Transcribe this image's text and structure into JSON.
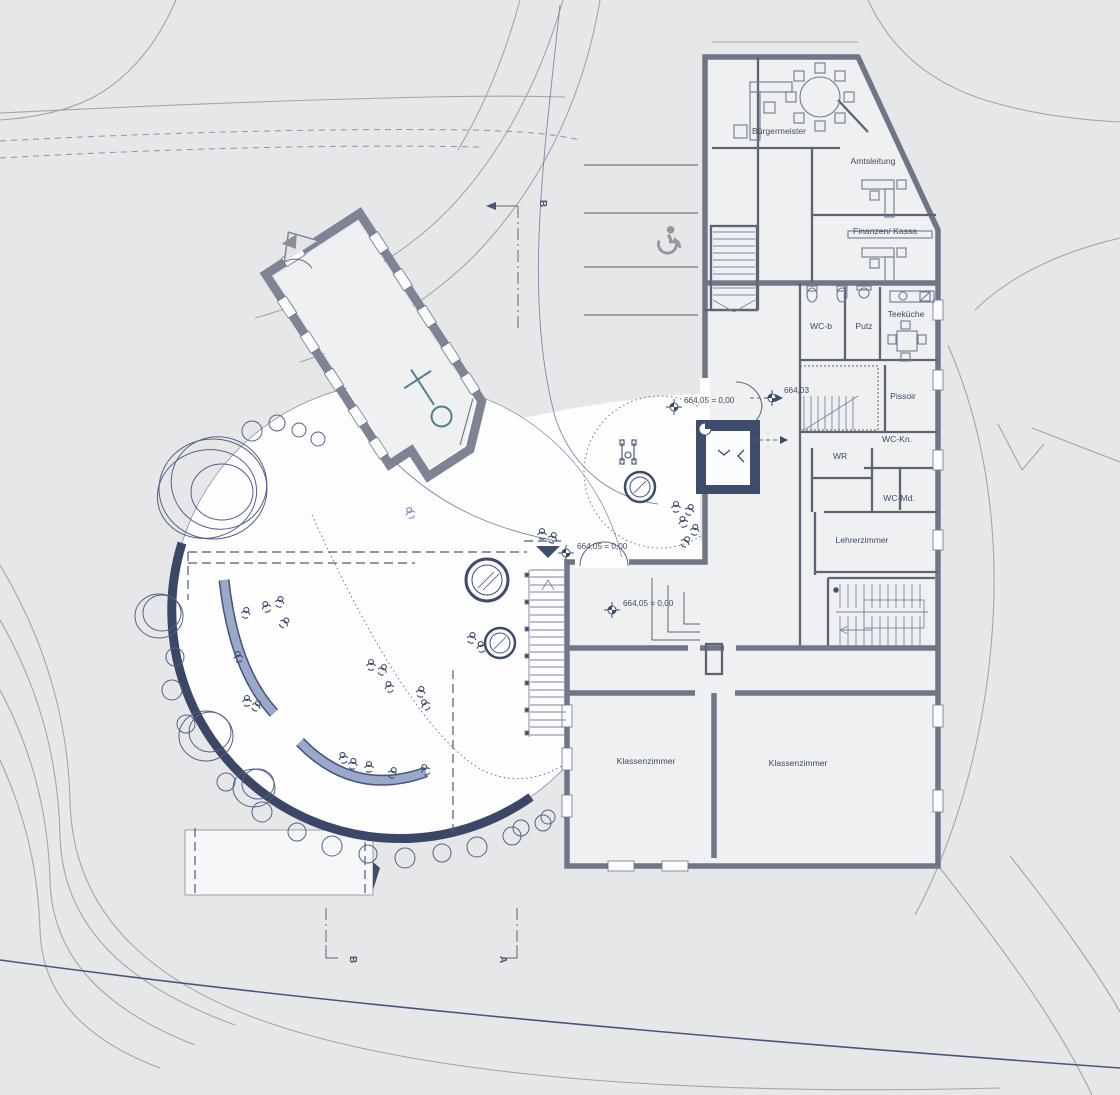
{
  "plan": {
    "type": "architectural-site-plan",
    "rooms": {
      "buergermeister": "Bürgermeister",
      "amtsleitung": "Amtsleitung",
      "finanzen": "Finanzen/ Kassa",
      "wc_b": "WC-b",
      "putz": "Putz",
      "teekueche": "Teeküche",
      "pissoir": "Pissoir",
      "wc_kn": "WC-Kn.",
      "wr": "WR",
      "wc_md": "WC-Md.",
      "lehrerzimmer": "Lehrerzimmer",
      "klassenzimmer_1": "Klassenzimmer",
      "klassenzimmer_2": "Klassenzimmer"
    },
    "levels": {
      "court_upper": "664,05 = 0,00",
      "side_entry": "664,03",
      "plaza_entry": "664,05 = 0,00",
      "hall": "664,05 = 0,00"
    },
    "sections": {
      "b_top": "B",
      "b_bottom": "B",
      "a_bottom": "A"
    },
    "icons": [
      "wheelchair-parking-icon",
      "altar-cross-icon",
      "benchmark-icon",
      "entrance-marker-icon",
      "person-figure-icon",
      "stroller-walker-icon"
    ],
    "colors": {
      "background": "#e6e7e9",
      "plaza_white": "#fdfdfe",
      "wall_gray": "#6e7687",
      "navy": "#3e4c6d",
      "bench_blue": "#9aa9c9",
      "contour_gray": "#a3a5a9",
      "cross_teal": "#517f8d",
      "label_text": "#3f4a63"
    }
  }
}
